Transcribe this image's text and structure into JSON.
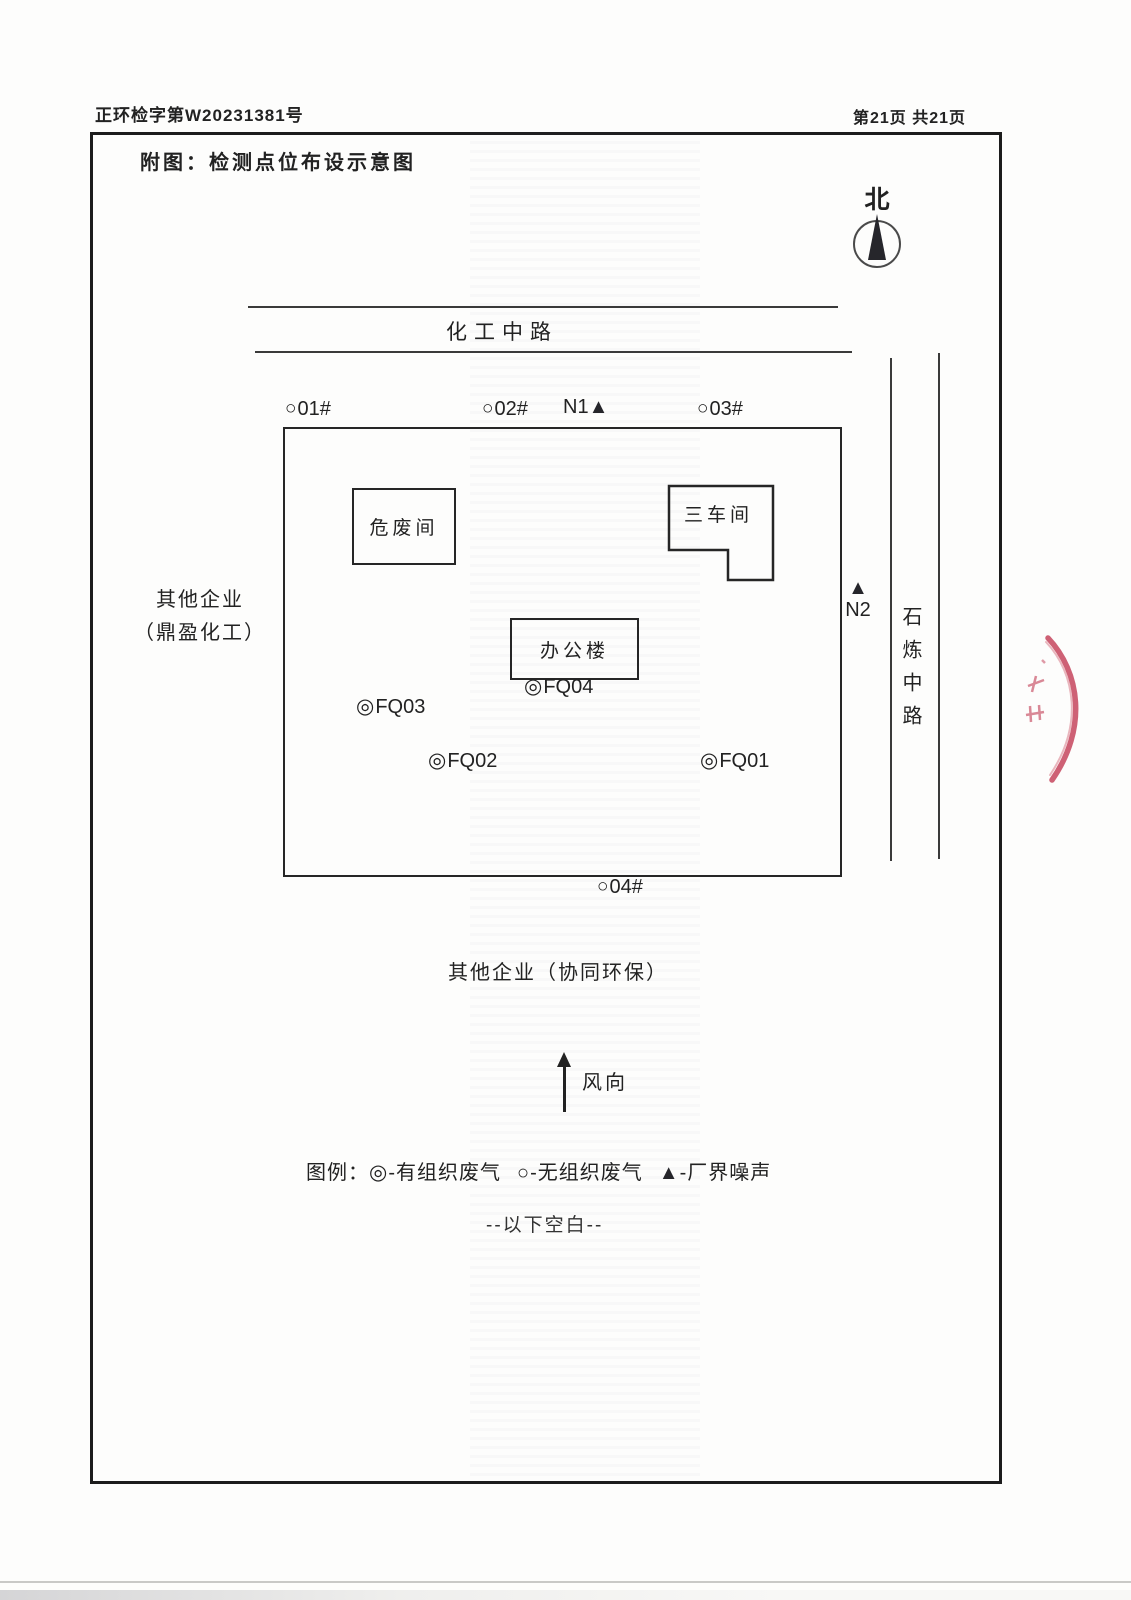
{
  "document": {
    "doc_number": "正环检字第W20231381号",
    "page_indicator": "第21页 共21页",
    "title": "附图：检测点位布设示意图",
    "below_blank_note": "--以下空白--"
  },
  "compass": {
    "north_label": "北"
  },
  "roads": {
    "top_road": "化工中路",
    "right_road": "石炼中路"
  },
  "factory": {
    "buildings": {
      "hazardous_waste_room": "危废间",
      "workshop_3": "三车间",
      "office_building": "办公楼"
    }
  },
  "neighbors": {
    "left_line1": "其他企业",
    "left_line2": "（鼎盈化工）",
    "bottom": "其他企业（协同环保）"
  },
  "symbols": {
    "unorganized_gas": "○",
    "organized_gas": "◎",
    "boundary_noise": "▲"
  },
  "boundary_points": {
    "p01": "01#",
    "p02": "02#",
    "p03": "03#",
    "p04": "04#"
  },
  "noise_points": {
    "n1": "N1",
    "n2": "N2"
  },
  "organized_points": {
    "fq01": "FQ01",
    "fq02": "FQ02",
    "fq03": "FQ03",
    "fq04": "FQ04"
  },
  "wind": {
    "label": "风向"
  },
  "legend": {
    "prefix": "图例：",
    "organized_text": "-有组织废气",
    "unorganized_text": "-无组织废气",
    "noise_text": "-厂界噪声"
  },
  "colors": {
    "ink": "#1f1f1f",
    "stamp_red": "#c23a52"
  }
}
